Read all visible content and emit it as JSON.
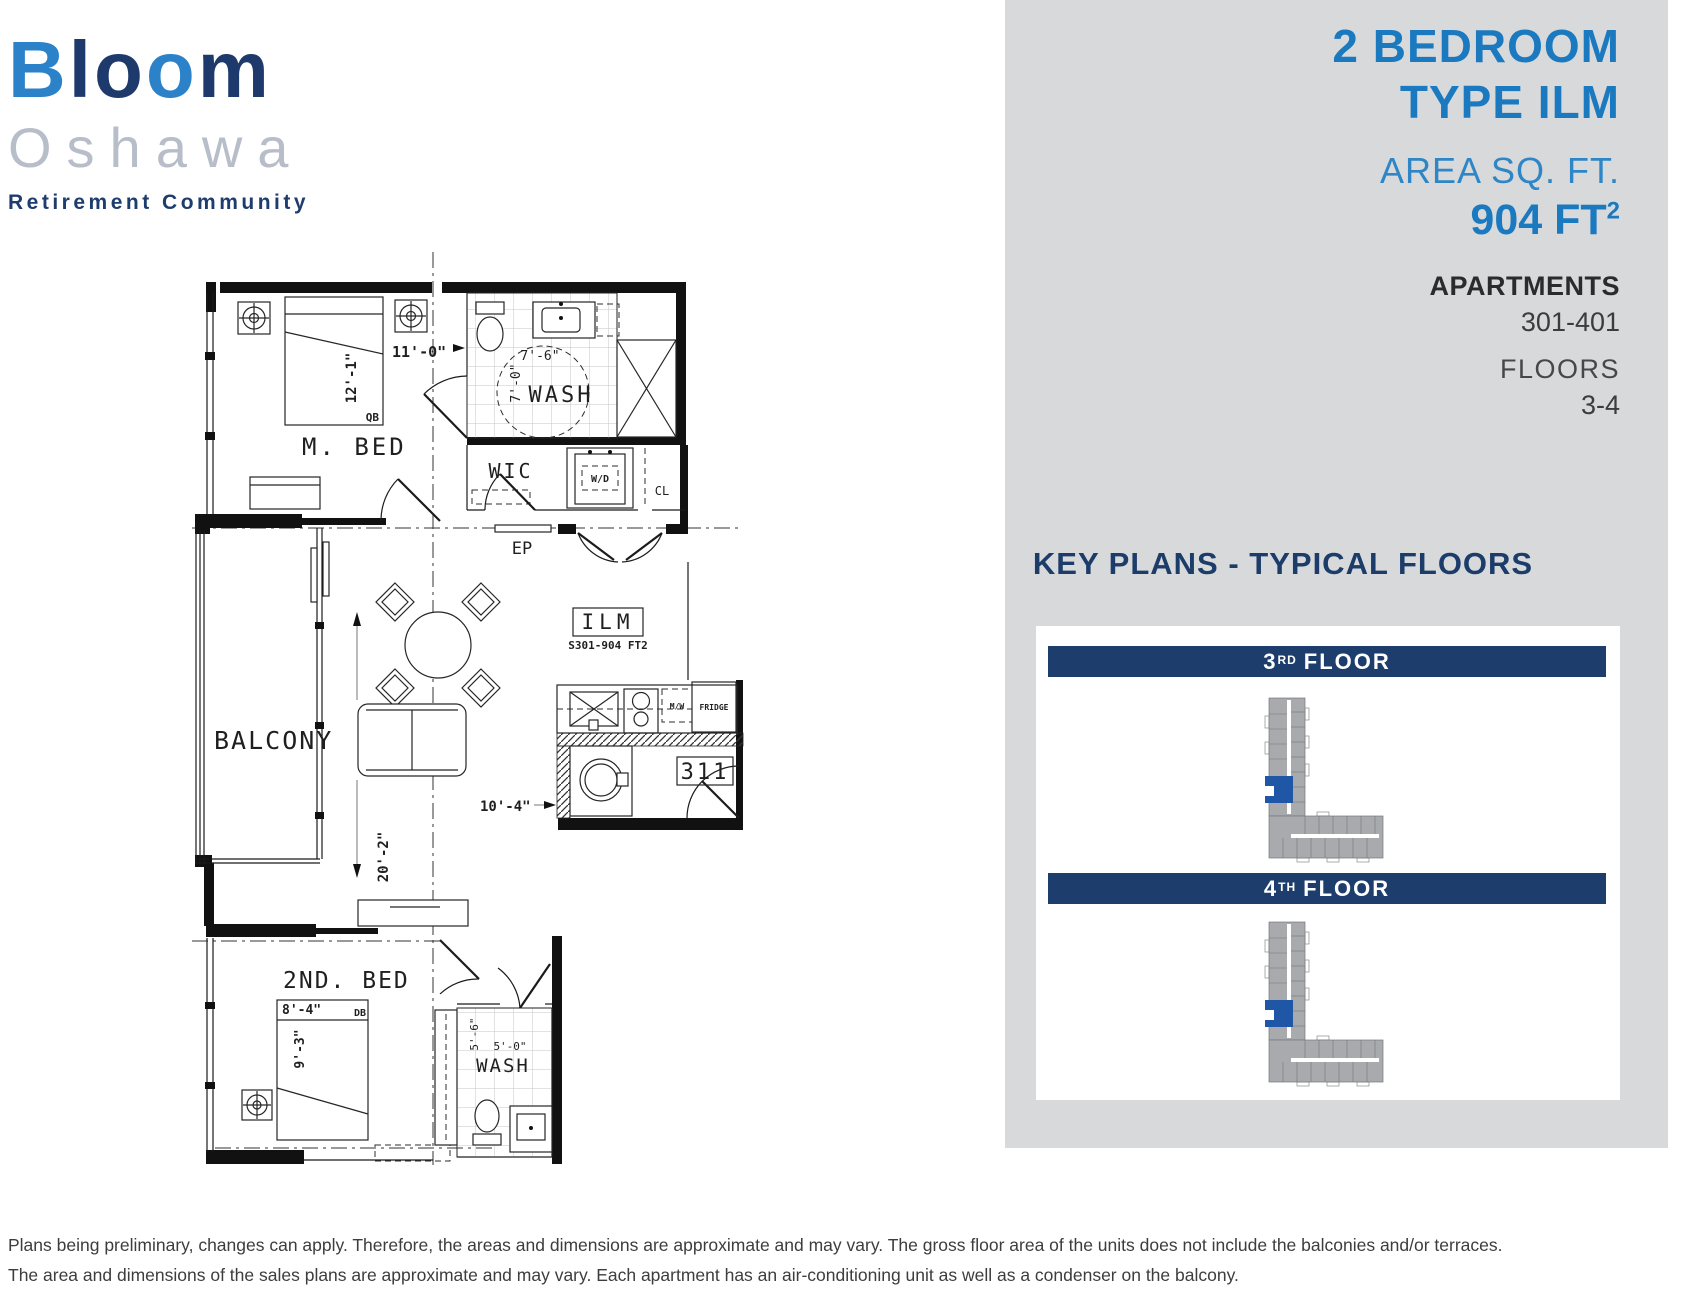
{
  "logo": {
    "seg1": "B",
    "seg2": "lo",
    "seg3": "o",
    "seg4": "m",
    "line2": "Oshawa",
    "line3": "Retirement Community"
  },
  "header": {
    "title_line1": "2 BEDROOM",
    "title_line2": "TYPE ILM",
    "area_label": "AREA SQ. FT.",
    "area_value": "904 FT",
    "area_unit_sup": "2",
    "apartments_label": "APARTMENTS",
    "apartments_value": "301-401",
    "floors_label": "FLOORS",
    "floors_value": "3-4"
  },
  "key_plans": {
    "title": "KEY PLANS - TYPICAL FLOORS",
    "floors": [
      {
        "number": "3",
        "suffix": "RD",
        "word": "FLOOR"
      },
      {
        "number": "4",
        "suffix": "TH",
        "word": "FLOOR"
      }
    ]
  },
  "floor_plan": {
    "master_bed_label": "M. BED",
    "master_bed_width": "11'-0\"",
    "master_bed_length": "12'-1\"",
    "master_bed_type": "QB",
    "bath_label": "WASH",
    "bath_width": "7'-6\"",
    "bath_length": "7'-0\"",
    "wic_label": "WIC",
    "laundry_label": "W/D",
    "closet_label": "CL",
    "panel_label": "EP",
    "unit_type": "ILM",
    "unit_area_code": "S301-904 FT2",
    "unit_number": "311",
    "balcony_label": "BALCONY",
    "living_length": "20'-2\"",
    "living_width": "10'-4\"",
    "fridge_label": "FRIDGE",
    "microwave_label": "M/W",
    "second_bed_label": "2ND. BED",
    "second_bed_width": "8'-4\"",
    "second_bed_length": "9'-3\"",
    "second_bed_type": "DB",
    "bath2_label": "WASH",
    "bath2_length": "5'-6\"",
    "bath2_width": "5'-0\""
  },
  "disclaimer": {
    "line1": "Plans being preliminary, changes can apply. Therefore, the areas and dimensions are approximate and may vary. The gross floor area of the units does not include the balconies and/or terraces.",
    "line2": "The area and dimensions of the sales plans are approximate and may vary. Each apartment has an air-conditioning unit as well as a condenser on the balcony."
  },
  "colors": {
    "brand_blue": "#1b79c0",
    "brand_navy": "#1e3c6e",
    "logo_gray": "#b7bdc9",
    "panel_gray": "#d8d9db",
    "bar_navy": "#1d3e6c",
    "keyplan_gray": "#a8aaad",
    "highlight_blue": "#1f57a6"
  }
}
